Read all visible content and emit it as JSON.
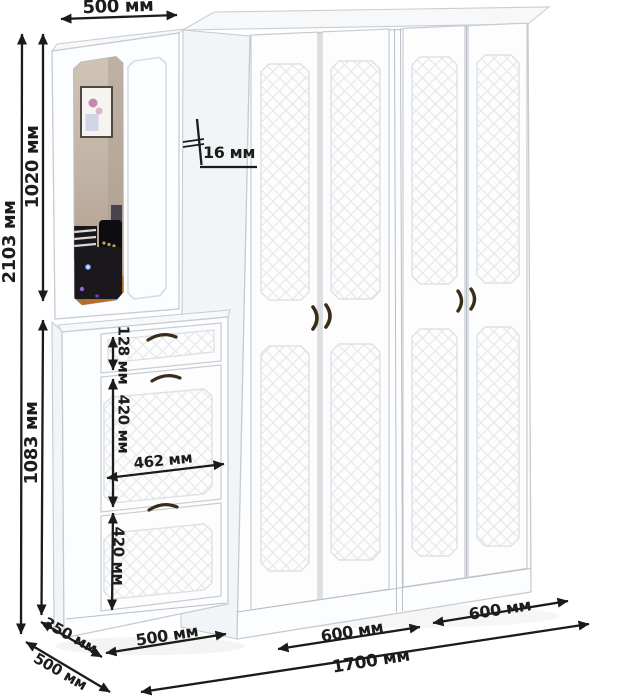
{
  "dimensions": {
    "top_width": "500 мм",
    "total_height": "2103 мм",
    "upper_section_height": "1020 мм",
    "lower_section_height": "1083 мм",
    "drawer_front_height": "128 мм",
    "shoe_door_upper_height": "420 мм",
    "shoe_door_width": "462 мм",
    "shoe_door_lower_height": "420 мм",
    "panel_thickness": "16 мм",
    "shoe_cabinet_depth": "350 мм",
    "total_depth": "500 мм",
    "shoe_cabinet_width": "500 мм",
    "wardrobe_left_section_width": "600 мм",
    "wardrobe_right_section_width": "600 мм",
    "total_width": "1700 мм"
  },
  "colors": {
    "dimension_ink": "#1b1b19",
    "furniture_outline": "#c6cbd0",
    "lattice_line": "#e3e7ea",
    "handle_bronze": "#3a2d18",
    "mirror_wall": "#c2b4a5",
    "mirror_floor": "#b26f2c"
  }
}
